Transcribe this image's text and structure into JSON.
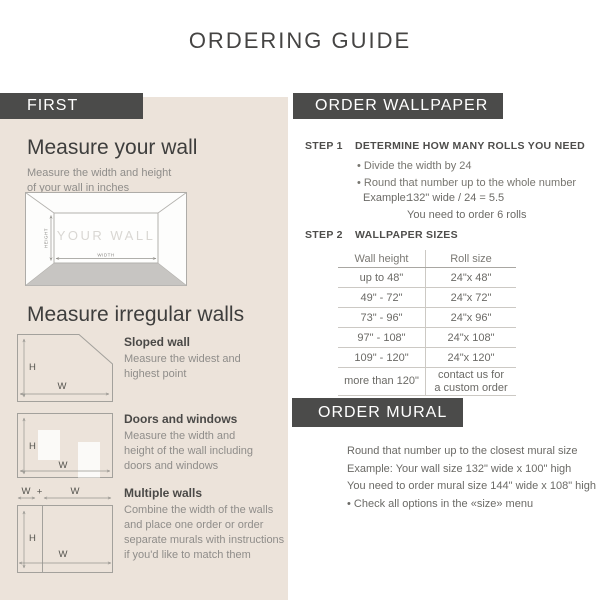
{
  "title": "ORDERING GUIDE",
  "colors": {
    "band_bg": "#4b4b4a",
    "panel_bg": "#ece3da"
  },
  "left": {
    "band": "FIRST",
    "measure_wall": {
      "heading": "Measure your wall",
      "body": "Measure the width and height\nof your wall in inches",
      "diagram": {
        "wall_label": "YOUR WALL",
        "height_label": "HEIGHT",
        "width_label": "WIDTH"
      }
    },
    "irregular": {
      "heading": "Measure irregular walls",
      "h_label": "H",
      "w_label": "W",
      "plus": "+",
      "sloped": {
        "label": "Sloped wall",
        "body": "Measure the widest and\nhighest point"
      },
      "doors": {
        "label": "Doors and windows",
        "body": "Measure the width and\nheight of the wall including\ndoors and windows"
      },
      "multiple": {
        "label": "Multiple walls",
        "body": "Combine the width of the walls\nand place one order or order\nseparate murals with instructions\nif you'd like to match them"
      }
    }
  },
  "wallpaper": {
    "band": "ORDER WALLPAPER",
    "step1": {
      "label": "STEP 1",
      "title": "DETERMINE HOW MANY ROLLS YOU NEED",
      "bullets": [
        "• Divide the width by 24",
        "• Round that number up to the whole number"
      ],
      "example_label": "Example:",
      "example_value": "132\" wide / 24 = 5.5",
      "example_note": "You need to order 6 rolls"
    },
    "step2": {
      "label": "STEP 2",
      "title": "WALLPAPER SIZES",
      "table": {
        "headers": [
          "Wall height",
          "Roll size"
        ],
        "rows": [
          [
            "up to 48\"",
            "24\"x 48\""
          ],
          [
            "49\" - 72\"",
            "24\"x 72\""
          ],
          [
            "73\" - 96\"",
            "24\"x 96\""
          ],
          [
            "97\" - 108\"",
            "24\"x 108\""
          ],
          [
            "109\" - 120\"",
            "24\"x 120\""
          ],
          [
            "more than 120\"",
            "contact us for\na custom order"
          ]
        ]
      }
    }
  },
  "mural": {
    "band": "ORDER MURAL",
    "lines": [
      "Round that number up to the closest mural size",
      "Example: Your wall size 132\" wide x 100\" high",
      "You need to order mural size 144\" wide x 108\" high",
      "• Check all options in the «size» menu"
    ]
  }
}
